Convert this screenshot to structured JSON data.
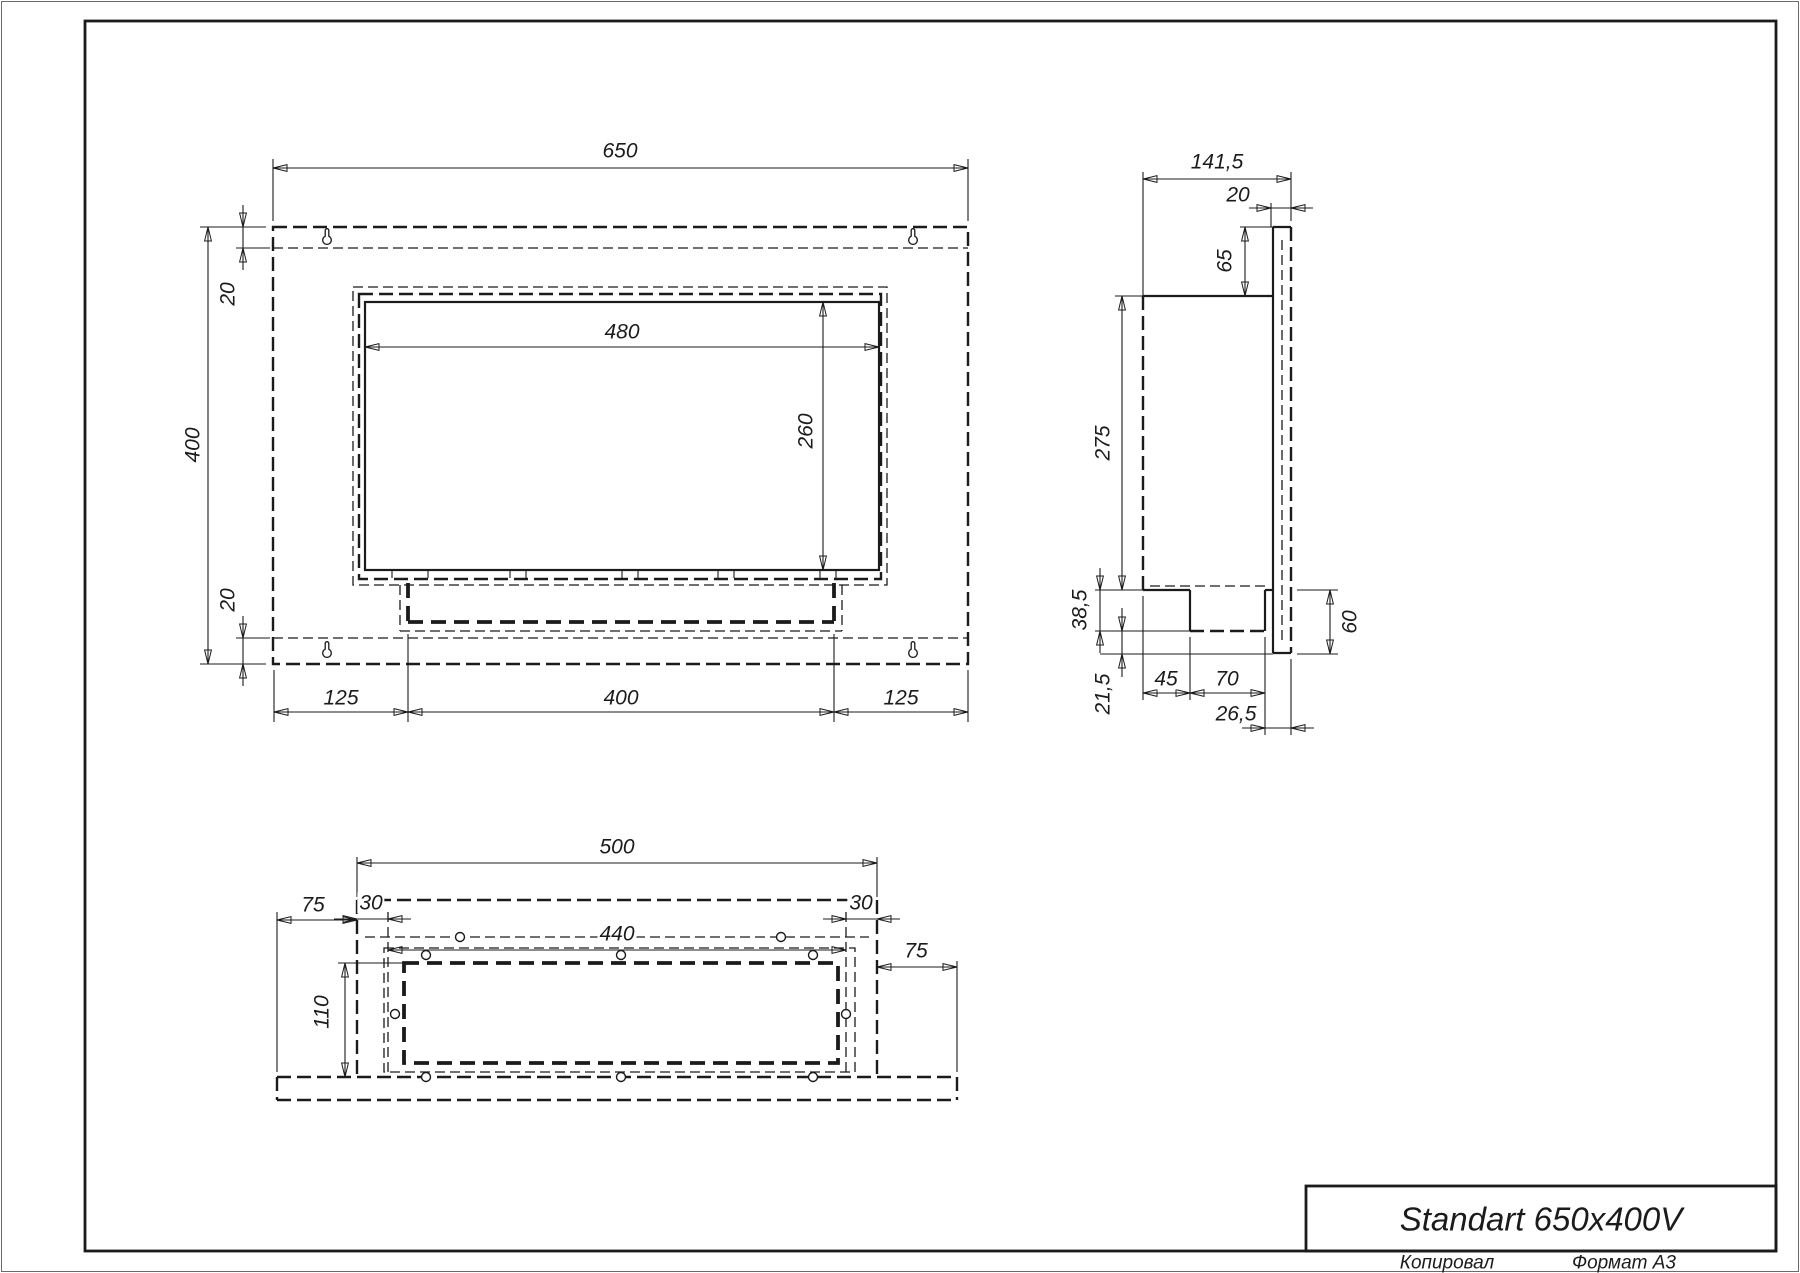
{
  "drawing": {
    "title": "Standart 650x400V",
    "footer": {
      "copied": "Копировал",
      "format": "Формат А3"
    },
    "colors": {
      "line": "#1b1b1b",
      "paper": "#ffffff"
    },
    "front_view": {
      "width": "650",
      "height": "400",
      "flange_top": "20",
      "flange_bottom": "20",
      "opening_width": "480",
      "opening_height": "260",
      "foot_left": "125",
      "foot_center": "400",
      "foot_right": "125"
    },
    "side_view": {
      "depth": "141,5",
      "front_plate": "20",
      "top_inset": "65",
      "body_height": "275",
      "tray_height": "38,5",
      "bottom_inset": "21,5",
      "tray_offset": "45",
      "tray_depth": "70",
      "outlet_offset": "26,5",
      "bottom_total": "60"
    },
    "bottom_view": {
      "body_width": "500",
      "hole_inset_left": "30",
      "hole_span": "440",
      "hole_inset_right": "30",
      "flange_left": "75",
      "cavity_depth": "110",
      "flange_right": "75"
    }
  }
}
